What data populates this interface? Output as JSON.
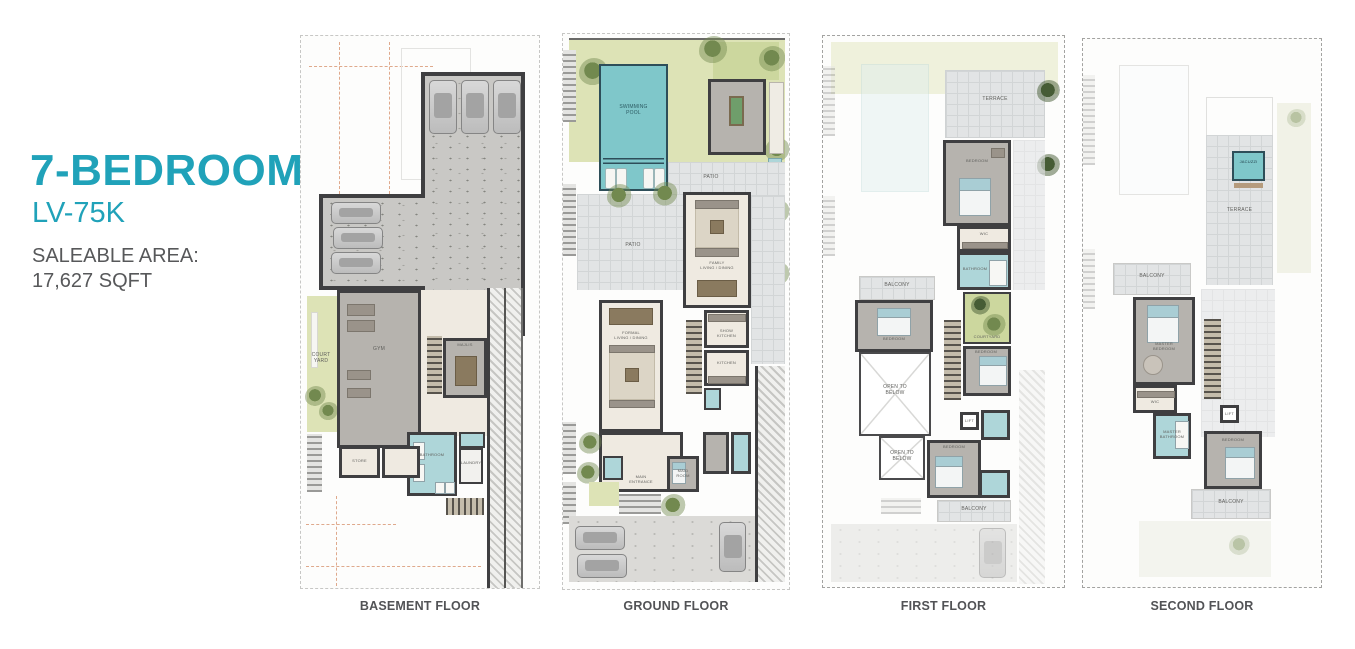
{
  "header": {
    "title": "7-BEDROOM",
    "subtitle": "LV-75K",
    "saleable_label": "SALEABLE AREA:",
    "saleable_value": "17,627 SQFT"
  },
  "colors": {
    "accent_teal": "#20A2B9",
    "text_gray": "#57585A",
    "pool_teal": "#7FC7CA",
    "bath_teal": "#AED6D9",
    "grass_green": "#DDE3B6",
    "wall_dark": "#3F3F41",
    "caption_gray": "#525356"
  },
  "floors": {
    "basement": {
      "caption": "BASEMENT FLOOR",
      "rooms": {
        "courtyard": "COURT\nYARD",
        "gym": "GYM",
        "majlis": "MAJLIS",
        "bathroom": "BATHROOM",
        "laundry": "LAUNDRY",
        "store": "STORE"
      }
    },
    "ground": {
      "caption": "GROUND FLOOR",
      "rooms": {
        "pool": "SWIMMING\nPOOL",
        "patio": "PATIO",
        "family": "FAMILY\nLIVING / DINING",
        "formal": "FORMAL\nLIVING / DINING",
        "show_kitchen": "SHOW\nKITCHEN",
        "kitchen": "KITCHEN",
        "maid": "MAID\nROOM",
        "entrance": "MAIN\nENTRANCE"
      }
    },
    "first": {
      "caption": "FIRST FLOOR",
      "rooms": {
        "terrace": "TERRACE",
        "bedroom": "BEDROOM",
        "wic": "WIC",
        "bathroom": "BATHROOM",
        "courtyard": "COURTYARD",
        "balcony": "BALCONY",
        "open_below": "OPEN TO\nBELOW",
        "lift": "LIFT"
      }
    },
    "second": {
      "caption": "SECOND FLOOR",
      "rooms": {
        "jacuzzi": "JACUZZI",
        "terrace": "TERRACE",
        "master_bedroom": "MASTER\nBEDROOM",
        "wic": "WIC",
        "master_bathroom": "MASTER\nBATHROOM",
        "bedroom": "BEDROOM",
        "balcony": "BALCONY",
        "lift": "LIFT"
      }
    }
  }
}
